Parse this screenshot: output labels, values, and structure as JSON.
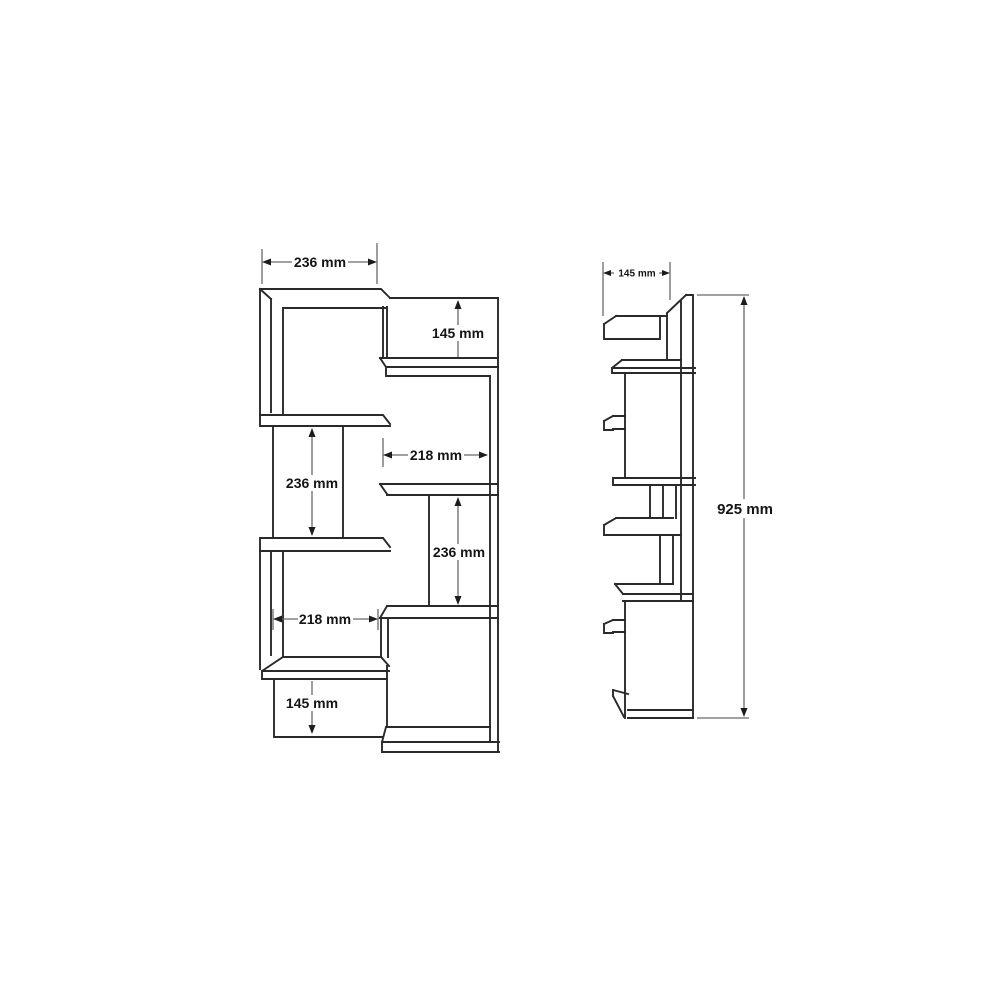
{
  "colors": {
    "background": "#ffffff",
    "outline": "#2a2a2a",
    "dimension_line": "#6a6a6a",
    "arrowhead": "#1c1c1c",
    "label_text": "#151515"
  },
  "front_view": {
    "dimensions": {
      "width_top": "236 mm",
      "gap_top_right": "145 mm",
      "gap_left_mid": "236 mm",
      "width_mid_right": "218 mm",
      "gap_right_lower": "236 mm",
      "width_lower_left": "218 mm",
      "gap_bottom_left": "145 mm"
    }
  },
  "side_view": {
    "dimensions": {
      "depth_top": "145 mm",
      "height": "925 mm"
    }
  }
}
